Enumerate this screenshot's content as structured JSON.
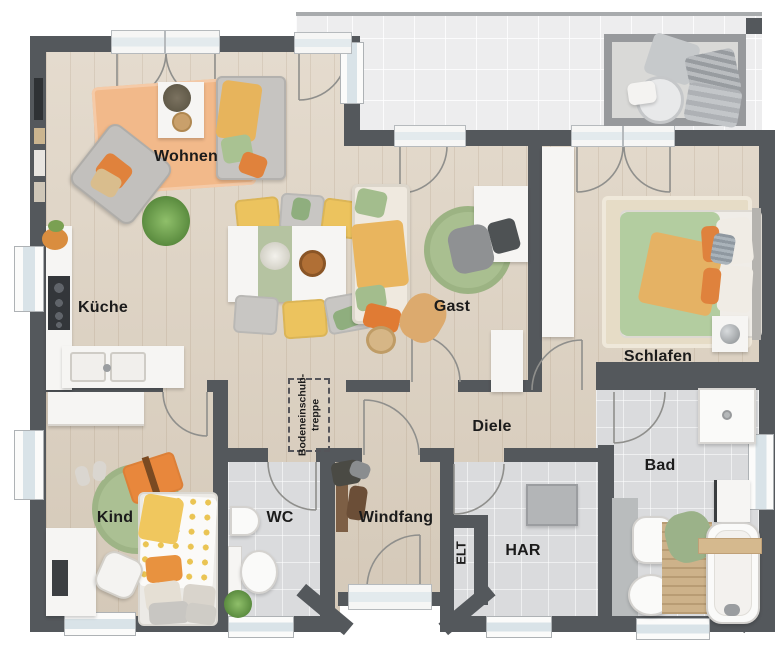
{
  "rooms": {
    "wohnen": "Wohnen",
    "kueche": "Küche",
    "gast": "Gast",
    "schlafen": "Schlafen",
    "diele": "Diele",
    "kind": "Kind",
    "wc": "WC",
    "windfang": "Windfang",
    "elt": "ELT",
    "har": "HAR",
    "bad": "Bad"
  },
  "annotations": {
    "attic_ladder_line1": "Bodeneinschub-",
    "attic_ladder_line2": "treppe"
  },
  "colors": {
    "wall": "#54585c",
    "wood_floor": "#ddd1c0",
    "tile_floor": "#dadbdd",
    "terrace_floor": "#ededee",
    "accent_orange": "#e0823c",
    "accent_yellow": "#ecc35e",
    "accent_green": "#a9bf90",
    "rug_peach": "#f2b98a",
    "label_text": "#1b1b1b"
  }
}
